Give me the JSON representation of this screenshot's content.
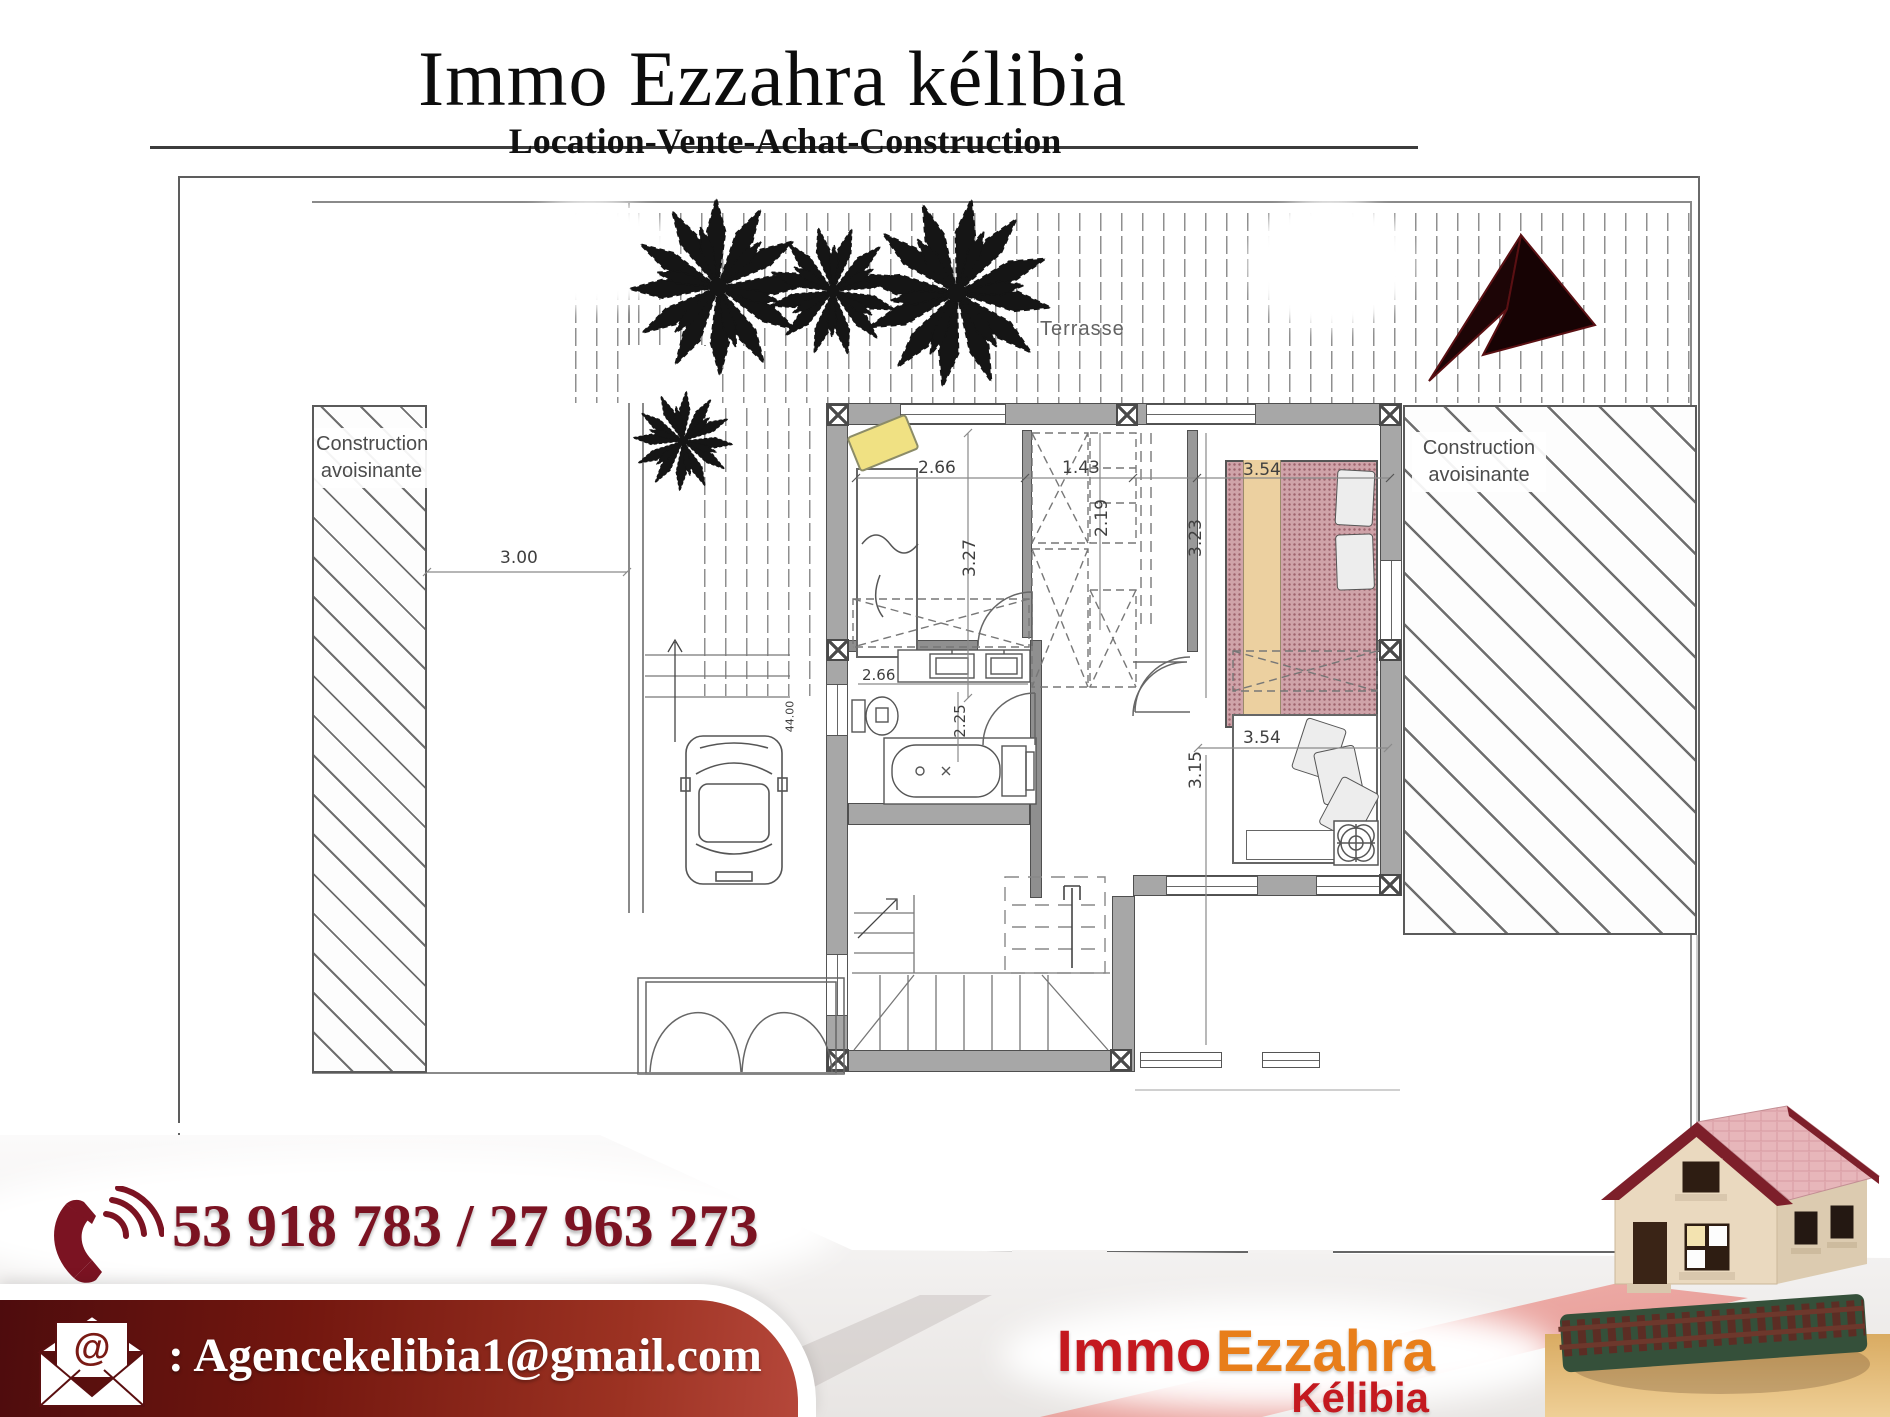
{
  "header": {
    "title": "Immo Ezzahra kélibia",
    "subtitle": "Location-Vente-Achat-Construction"
  },
  "plan": {
    "terrace_label": "Terrasse",
    "neighbor_left": {
      "line1": "Construction",
      "line2": "avoisinante"
    },
    "neighbor_right": {
      "line1": "Construction",
      "line2": "avoisinante"
    },
    "dimensions": {
      "setback": "3.00",
      "ch1_width": "2.66",
      "closet_width": "1.43",
      "ch2_width": "3.54",
      "ch1_height": "3.27",
      "closet_height": "2.19",
      "ch2_height": "3.23",
      "bath_width": "2.66",
      "wc_height": "2.25",
      "ch3_width": "3.54",
      "ch3_height": "3.15",
      "garage_length": "44.00"
    }
  },
  "contact": {
    "phone": "53 918 783 / 27 963 273",
    "email_prefix": ":",
    "email": "Agencekelibia1@gmail.com",
    "at_symbol": "@"
  },
  "logo": {
    "word1": "Immo",
    "word2": "Ezzahra",
    "word3": "Kélibia"
  },
  "colors": {
    "maroon": "#7b1322",
    "bar_dark": "#4e0c0d",
    "bar_light": "#b5473a",
    "logo_red": "#c4191f",
    "logo_orange": "#e87e1a",
    "plan_wall": "#a7a7a7",
    "bed_pink": "#cfa3a9",
    "blanket_beige": "#ecd0a0",
    "pillow_yellow": "#f0e183",
    "road_pink": "#e9948e"
  }
}
